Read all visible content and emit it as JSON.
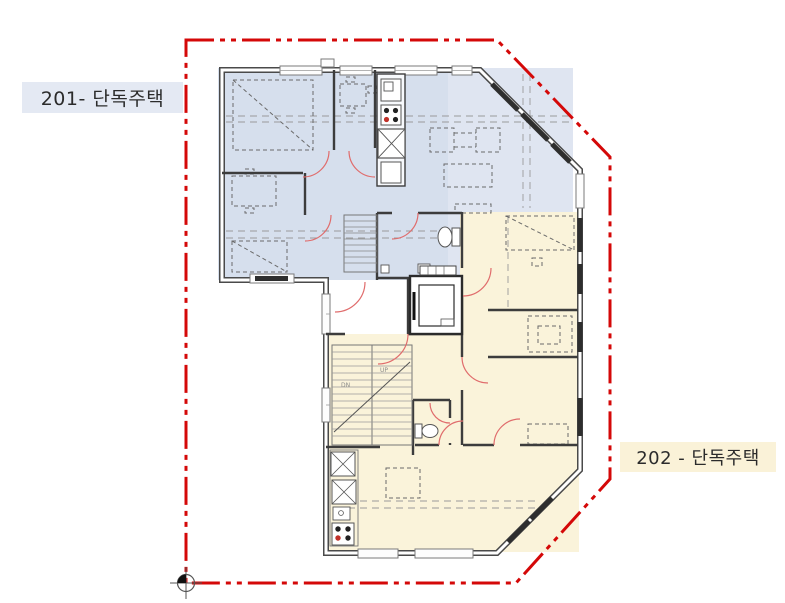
{
  "drawing": {
    "type": "architectural floor plan",
    "floor_units": [
      {
        "id": "201",
        "label": "201- 단독주택",
        "region_fill": "#dfe5f1",
        "region_fill_deep": "#c9d4e8",
        "label_bg": "#e4e9f3"
      },
      {
        "id": "202",
        "label": "202 - 단독주택",
        "region_fill": "#faf3da",
        "label_bg": "#faf2d8"
      }
    ],
    "boundary": {
      "color": "#d40808",
      "pattern": "dash-dot-dot",
      "width_px": 3
    },
    "plan": {
      "wall_color": "#3c3c3c",
      "window_frame_color": "#7a7a7a",
      "glazing_color": "#2e2e2e",
      "door_swing_color": "#e06c6c",
      "furniture_line_color": "#6a6a6a",
      "guide_dash_color": "#9a9a9a",
      "stair_up": "UP",
      "stair_down": "DN",
      "stove_burner_accent": "#c03028"
    },
    "icons": {
      "benchmark": "survey-benchmark-icon",
      "benchmark_colors": {
        "ring": "#555555",
        "fill_quadrant": "#111111"
      }
    }
  }
}
